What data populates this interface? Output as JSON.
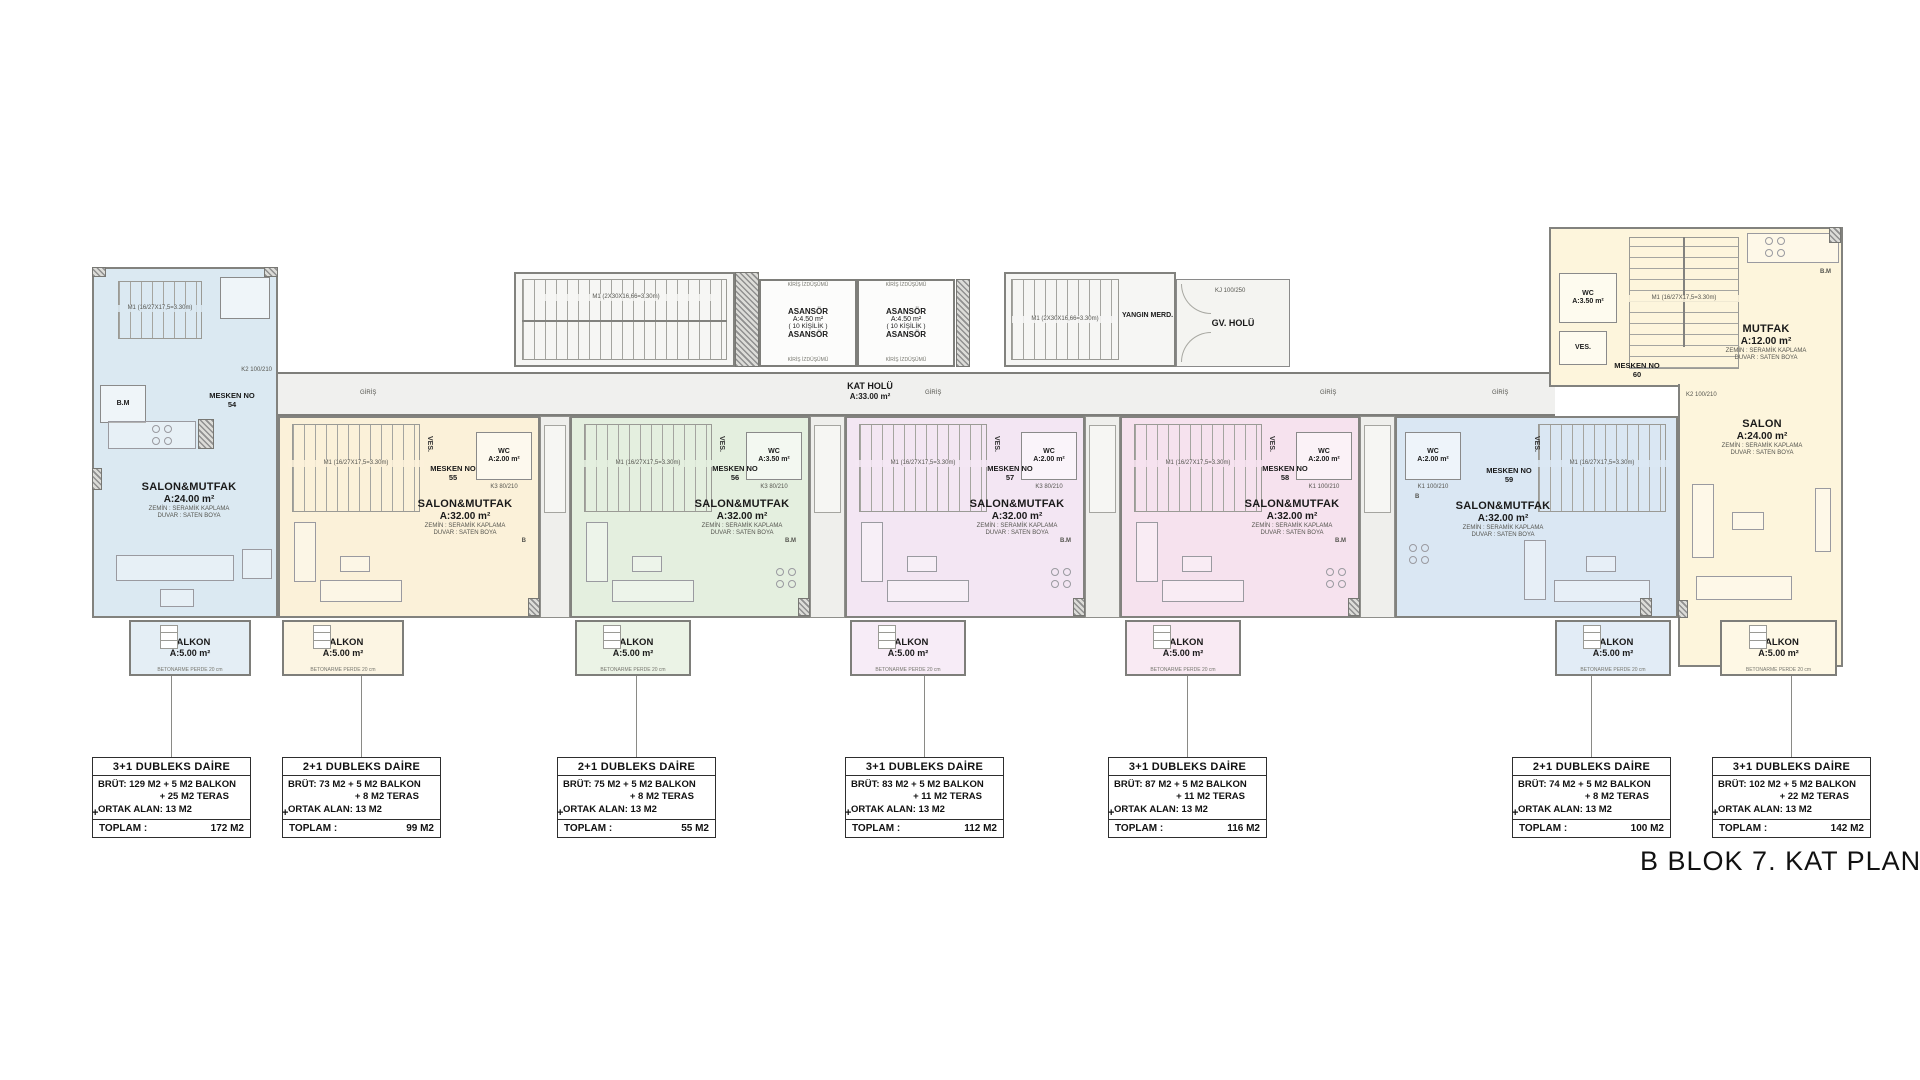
{
  "title": "B BLOK 7. KAT PLANI",
  "corridor": {
    "label": "KAT HOLÜ",
    "area": "A:33.00 m²",
    "giris": "GİRİŞ"
  },
  "elevator": {
    "l1": "ASANSÖR",
    "l2": "A:4.50 m²",
    "l3": "( 10 KİŞİLİK )",
    "l4": "ASANSÖR",
    "beam": "KİRİŞ İZDÜŞÜMÜ"
  },
  "fire_stairs": {
    "label": "YANGIN MERD.",
    "code": "M1 (2X30X16,66=3.30m)"
  },
  "gv_holu": {
    "label": "GV. HOLÜ",
    "door": "KJ 100/250"
  },
  "stairwell": {
    "code": "M1 (2X30X16,66=3.30m)"
  },
  "labels": {
    "ves": "VES.",
    "bm": "B.M",
    "b": "B",
    "k1": "K1 100/210",
    "k2": "K2 100/210",
    "k3": "K3 80/210",
    "unit_stair": "M1 (16/27X17,5=3.30m)",
    "betonarme": "BETONARME PERDE 20 cm",
    "finish1": "ZEMİN : SERAMİK KAPLAMA",
    "finish2": "DUVAR : SATEN BOYA"
  },
  "units": [
    {
      "mesken": "MESKEN NO",
      "no": "54",
      "room": "SALON&MUTFAK",
      "area": "A:24.00 m²"
    },
    {
      "mesken": "MESKEN NO",
      "no": "55",
      "room": "SALON&MUTFAK",
      "area": "A:32.00 m²",
      "wc": "WC",
      "wc_area": "A:2.00 m²"
    },
    {
      "mesken": "MESKEN NO",
      "no": "56",
      "room": "SALON&MUTFAK",
      "area": "A:32.00 m²",
      "wc": "WC",
      "wc_area": "A:3.50 m²"
    },
    {
      "mesken": "MESKEN NO",
      "no": "57",
      "room": "SALON&MUTFAK",
      "area": "A:32.00 m²",
      "wc": "WC",
      "wc_area": "A:2.00 m²"
    },
    {
      "mesken": "MESKEN NO",
      "no": "58",
      "room": "SALON&MUTFAK",
      "area": "A:32.00 m²",
      "wc": "WC",
      "wc_area": "A:2.00 m²"
    },
    {
      "mesken": "MESKEN NO",
      "no": "59",
      "room": "SALON&MUTFAK",
      "area": "A:32.00 m²",
      "wc": "WC",
      "wc_area": "A:2.00 m²"
    },
    {
      "mesken": "MESKEN NO",
      "no": "60",
      "salon": "SALON",
      "salon_area": "A:24.00 m²",
      "mutfak": "MUTFAK",
      "mutfak_area": "A:12.00 m²",
      "wc": "WC",
      "wc_area": "A:3.50 m²"
    }
  ],
  "balcony": {
    "label": "BALKON",
    "area": "A:5.00 m²"
  },
  "info_boxes": [
    {
      "type": "3+1 DUBLEKS DAİRE",
      "brut": "BRÜT: 129 M2 + 5 M2 BALKON",
      "teras": "+ 25 M2 TERAS",
      "ortak": "ORTAK ALAN: 13 M2",
      "toplam_label": "TOPLAM :",
      "toplam": "172 M2"
    },
    {
      "type": "2+1 DUBLEKS DAİRE",
      "brut": "BRÜT: 73 M2 + 5 M2 BALKON",
      "teras": "+ 8 M2 TERAS",
      "ortak": "ORTAK ALAN: 13 M2",
      "toplam_label": "TOPLAM :",
      "toplam": "99 M2"
    },
    {
      "type": "2+1 DUBLEKS DAİRE",
      "brut": "BRÜT: 75 M2 + 5 M2 BALKON",
      "teras": "+ 8 M2 TERAS",
      "ortak": "ORTAK ALAN: 13 M2",
      "toplam_label": "TOPLAM :",
      "toplam": "55 M2"
    },
    {
      "type": "3+1 DUBLEKS DAİRE",
      "brut": "BRÜT: 83 M2 + 5 M2 BALKON",
      "teras": "+ 11 M2 TERAS",
      "ortak": "ORTAK ALAN: 13 M2",
      "toplam_label": "TOPLAM :",
      "toplam": "112 M2"
    },
    {
      "type": "3+1 DUBLEKS DAİRE",
      "brut": "BRÜT: 87 M2 + 5 M2 BALKON",
      "teras": "+ 11 M2 TERAS",
      "ortak": "ORTAK ALAN: 13 M2",
      "toplam_label": "TOPLAM :",
      "toplam": "116 M2"
    },
    {
      "type": "2+1 DUBLEKS DAİRE",
      "brut": "BRÜT: 74 M2 + 5 M2 BALKON",
      "teras": "+ 8 M2 TERAS",
      "ortak": "ORTAK ALAN: 13 M2",
      "toplam_label": "TOPLAM :",
      "toplam": "100 M2"
    },
    {
      "type": "3+1 DUBLEKS DAİRE",
      "brut": "BRÜT: 102 M2 + 5 M2 BALKON",
      "teras": "+ 22 M2 TERAS",
      "ortak": "ORTAK ALAN: 13 M2",
      "toplam_label": "TOPLAM :",
      "toplam": "142 M2"
    }
  ],
  "plus": "+"
}
